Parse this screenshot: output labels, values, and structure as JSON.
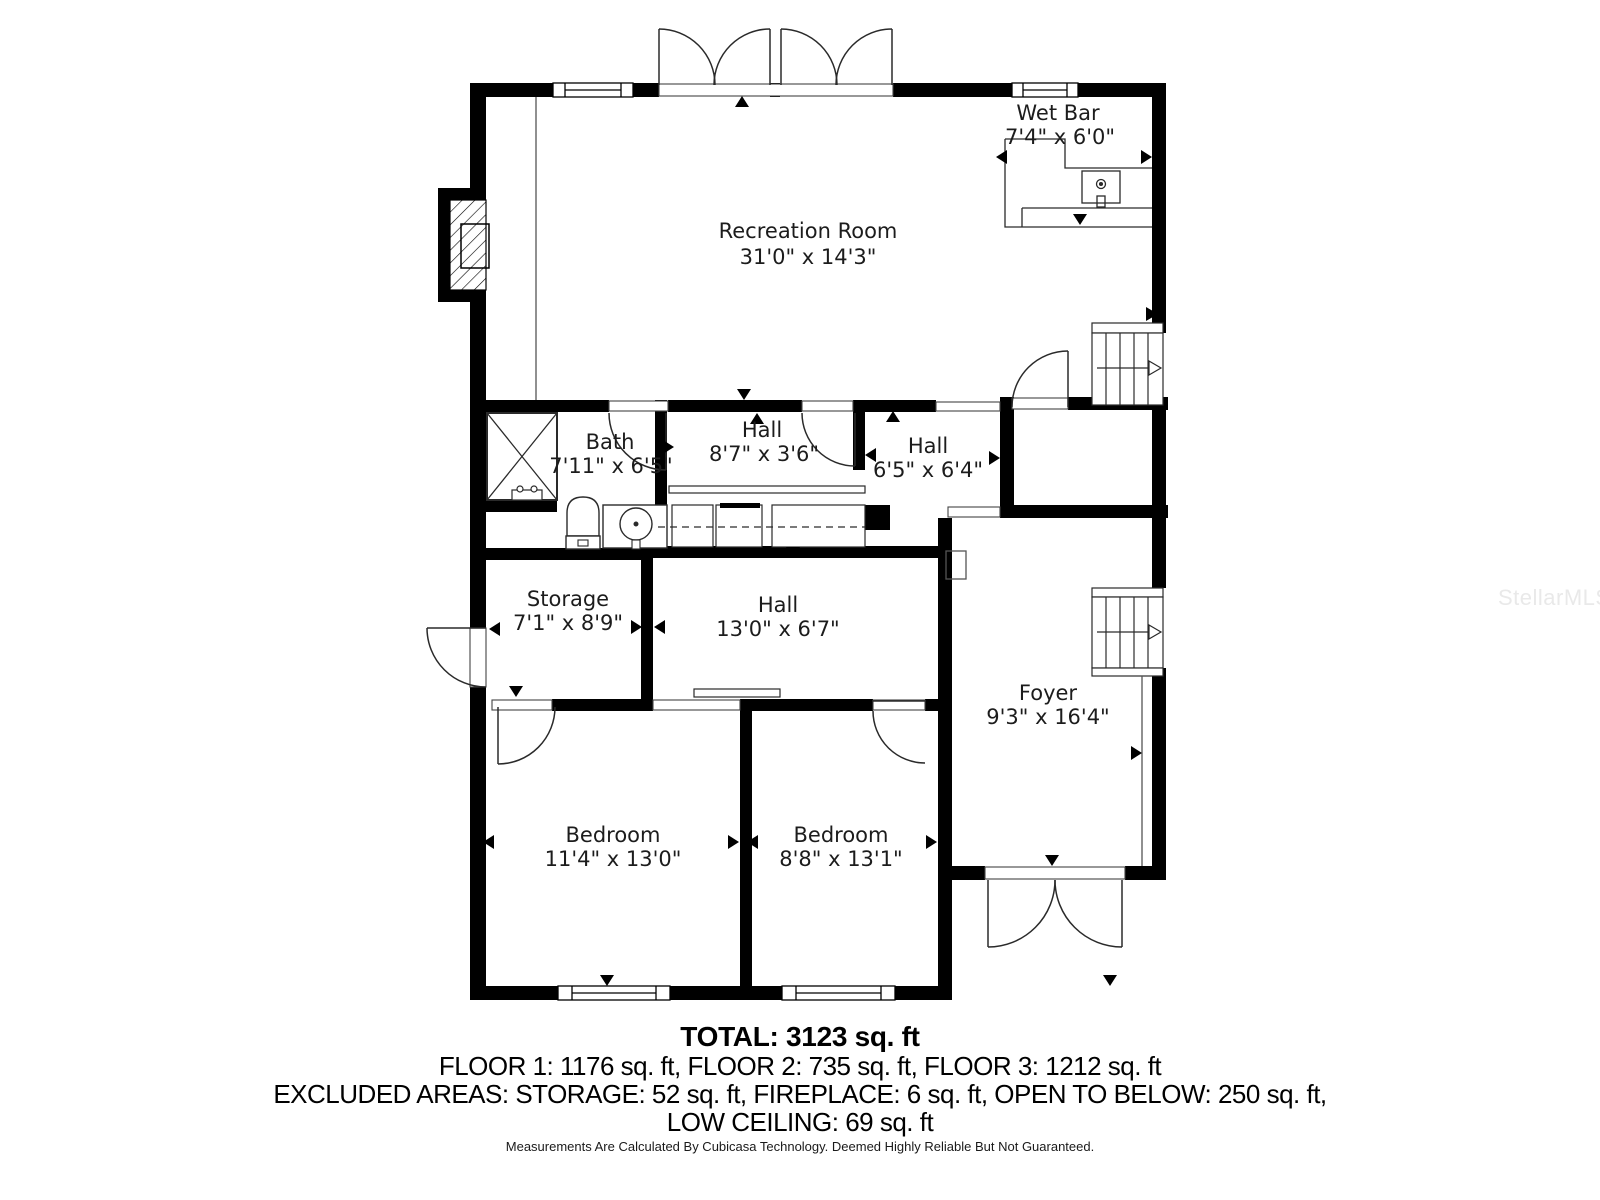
{
  "watermark": {
    "text": "StellarMLS"
  },
  "rooms": {
    "wet_bar": {
      "name": "Wet Bar",
      "dims": "7'4\" x 6'0\""
    },
    "recreation": {
      "name": "Recreation Room",
      "dims": "31'0\" x 14'3\""
    },
    "bath": {
      "name": "Bath",
      "dims": "7'11\" x 6'5\""
    },
    "hall_upper": {
      "name": "Hall",
      "dims": "8'7\" x 3'6\""
    },
    "hall_mid": {
      "name": "Hall",
      "dims": "6'5\" x 6'4\""
    },
    "storage": {
      "name": "Storage",
      "dims": "7'1\" x 8'9\""
    },
    "hall_lower": {
      "name": "Hall",
      "dims": "13'0\" x 6'7\""
    },
    "foyer": {
      "name": "Foyer",
      "dims": "9'3\" x 16'4\""
    },
    "bedroom_left": {
      "name": "Bedroom",
      "dims": "11'4\" x 13'0\""
    },
    "bedroom_right": {
      "name": "Bedroom",
      "dims": "8'8\" x 13'1\""
    }
  },
  "summary": {
    "total": "TOTAL: 3123 sq. ft",
    "floors": "FLOOR 1: 1176 sq. ft, FLOOR 2: 735 sq. ft, FLOOR 3: 1212 sq. ft",
    "excluded_line1": "EXCLUDED AREAS: STORAGE: 52 sq. ft, FIREPLACE: 6 sq. ft, OPEN TO BELOW: 250 sq. ft,",
    "excluded_line2": "LOW CEILING: 69 sq. ft",
    "disclaimer": "Measurements Are Calculated By Cubicasa Technology. Deemed Highly Reliable But Not Guaranteed."
  },
  "colors": {
    "wall": "#000000",
    "line": "#2a2a2a",
    "watermark": "#e9e9e9"
  }
}
